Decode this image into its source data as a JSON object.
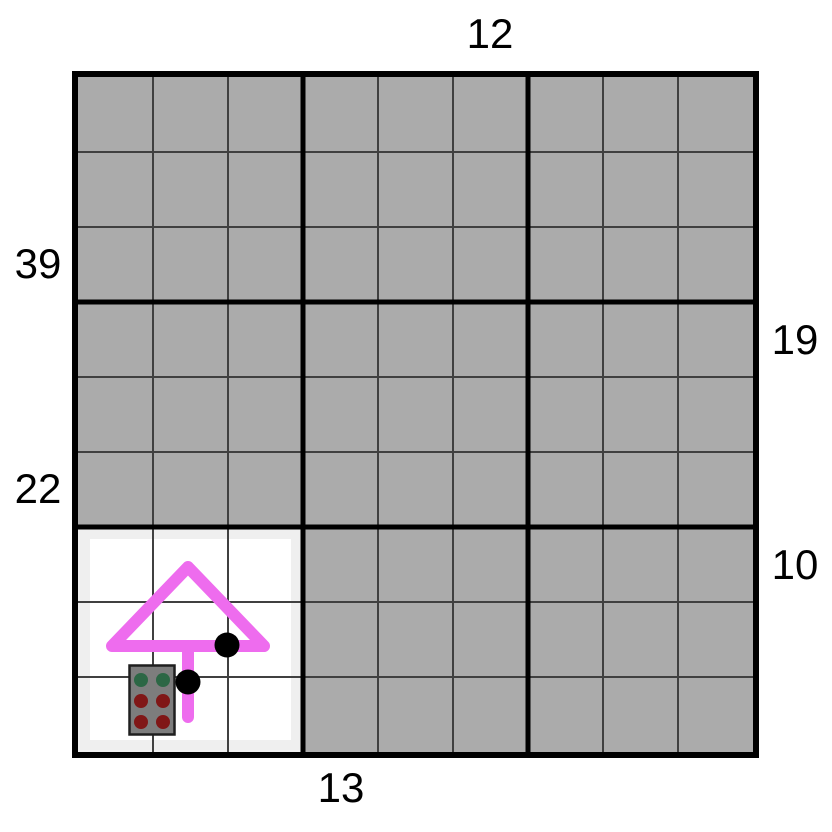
{
  "theme": {
    "page_bg": "#ffffff",
    "cell_hidden": "#ababab",
    "cell_revealed": "#ffffff",
    "reveal_shade": "#efefef",
    "grid_line_thin": "#404040",
    "grid_line_thick": "#000000",
    "arrow_color": "#ee6cee",
    "dot_color": "#000000",
    "sprite_body": "#7d7d7d",
    "sprite_border": "#1f1f1f",
    "sprite_dot_green": "#2c6745",
    "sprite_dot_red": "#801717",
    "label_color": "#000000"
  },
  "board": {
    "rows": 9,
    "cols": 9,
    "block_rows": 3,
    "block_cols": 3,
    "revealed_block": {
      "col_start": 0,
      "row_start": 6,
      "cols": 3,
      "rows": 3
    }
  },
  "clues": {
    "top": [
      {
        "text": "12",
        "col": 5
      }
    ],
    "bottom": [
      {
        "text": "13",
        "col": 3
      }
    ],
    "left": [
      {
        "text": "39",
        "row": 2
      },
      {
        "text": "22",
        "row": 5
      }
    ],
    "right": [
      {
        "text": "19",
        "row": 3
      },
      {
        "text": "10",
        "row": 6
      }
    ]
  },
  "objects": {
    "arrow_marker": {
      "shape": "up-arrow",
      "color": "#ee6cee",
      "location": "revealed block, column 1"
    },
    "path_dots": [
      {
        "col": 2,
        "row": 7
      },
      {
        "col": 1,
        "row": 8
      }
    ],
    "berry_sprite": {
      "dot_rows": [
        [
          "green",
          "green"
        ],
        [
          "red",
          "red"
        ],
        [
          "red",
          "red"
        ]
      ],
      "location": "revealed block, column 0-1, row 8"
    }
  }
}
